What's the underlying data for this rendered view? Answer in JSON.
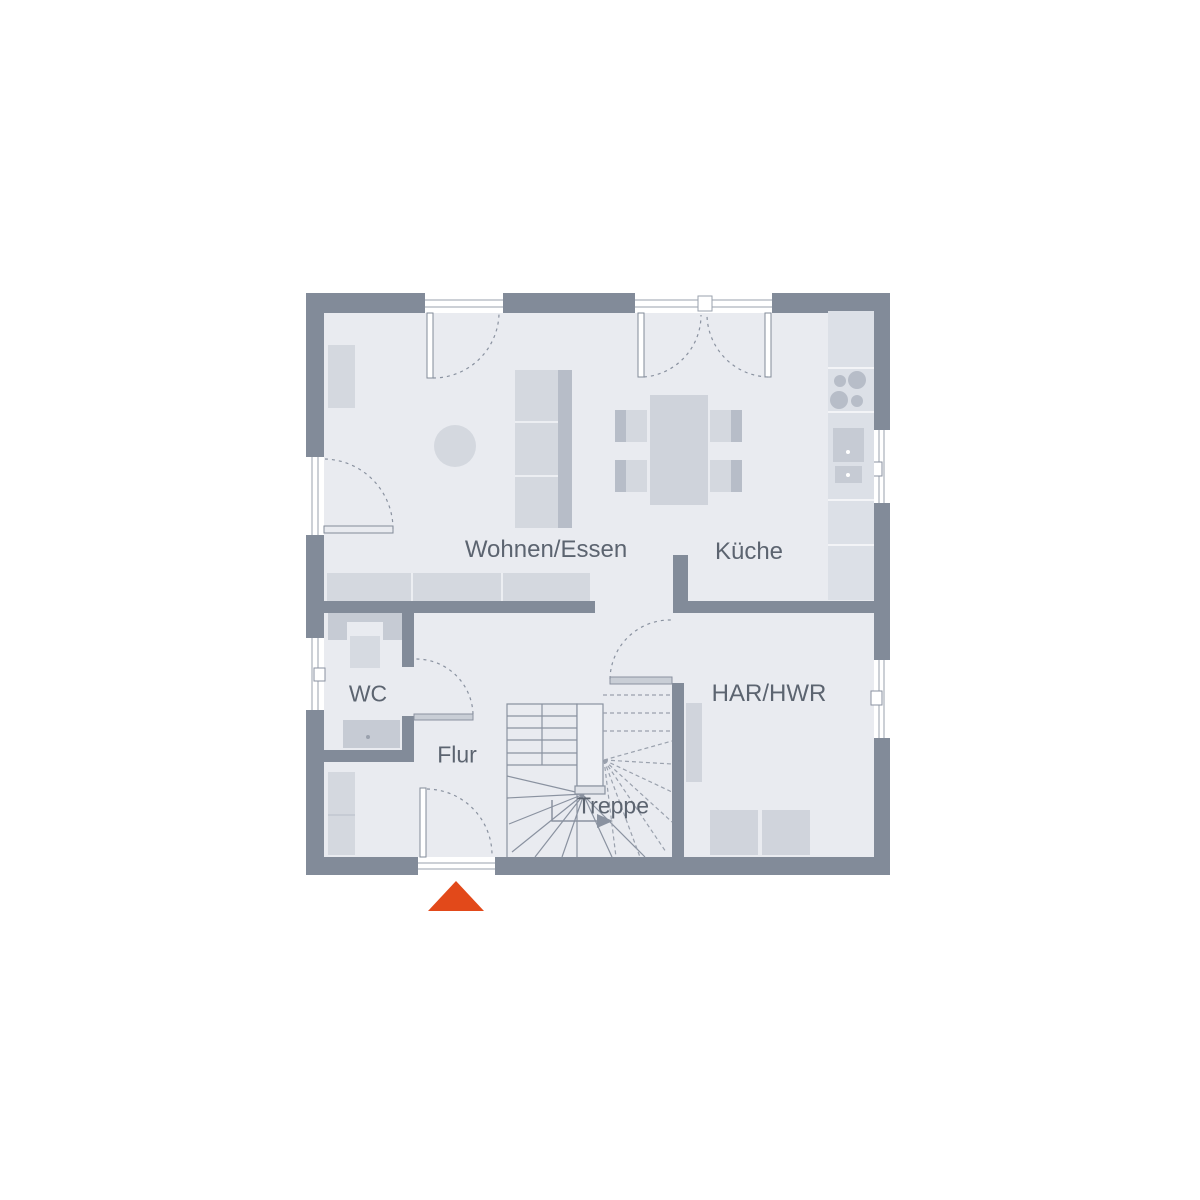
{
  "plan": {
    "type": "floor-plan",
    "rooms": [
      {
        "id": "wohnen-essen",
        "label": "Wohnen/Essen"
      },
      {
        "id": "kueche",
        "label": "Küche"
      },
      {
        "id": "wc",
        "label": "WC"
      },
      {
        "id": "flur",
        "label": "Flur"
      },
      {
        "id": "har-hwr",
        "label": "HAR/HWR"
      },
      {
        "id": "treppe",
        "label": "Treppe"
      }
    ],
    "colors": {
      "background": "#ffffff",
      "wall": "#828b99",
      "floor": "#e9ebf0",
      "furniture_light": "#d4d8df",
      "fixture_medium": "#c6cbd4",
      "furniture_dark": "#b7bdc8",
      "counter": "#dce0e7",
      "line": "#8a92a0",
      "label_text": "#5c6470",
      "entrance_accent": "#e2491a"
    },
    "icons": [
      "entrance-arrow-icon",
      "door-swing-arc",
      "stairs-walkline-arrow",
      "sofa",
      "tv-wall-unit",
      "sideboard",
      "round-rug",
      "dining-table",
      "chair",
      "kitchen-counter",
      "cooktop",
      "kitchen-sink",
      "toilet",
      "washbasin",
      "wardrobe",
      "utility-cabinet",
      "washer",
      "dryer"
    ]
  }
}
